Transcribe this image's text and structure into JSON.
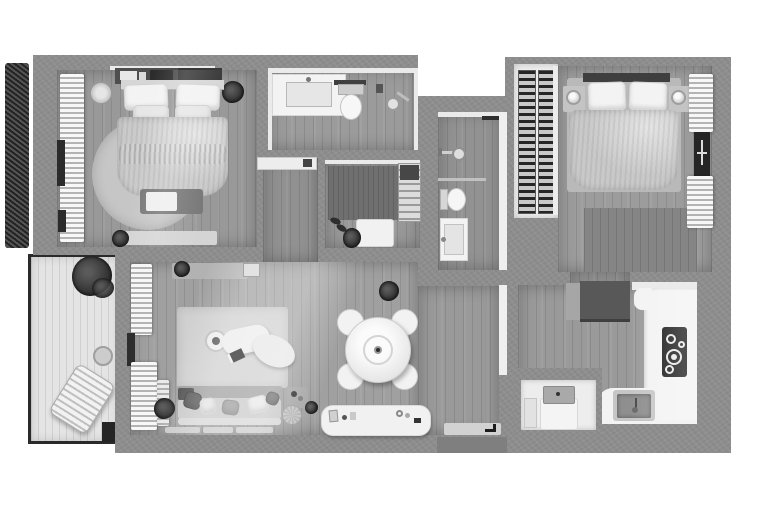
{
  "meta": {
    "type": "3d-floor-plan-render",
    "style": "grayscale top-down apartment rendering, no text labels",
    "canvas": {
      "width": 768,
      "height": 516
    }
  },
  "palette": {
    "background": "#ffffff",
    "wall_concrete": "#8d8d8d",
    "floor_wood_mid": "#9b9b9b",
    "floor_wood_dark": "#919191",
    "floor_balcony": "#e4e4e4",
    "white_fixture": "#f3f3f3",
    "textile_light": "#cbcbcb",
    "rug_light": "#d0d0d0",
    "rug_dark": "#6f6f6f",
    "appliance_dark": "#585858",
    "cooktop_black": "#161616",
    "plant_dark": "#343434",
    "window_glass": "#2b2b2b"
  },
  "rooms": [
    {
      "name": "bedroom-1",
      "furniture": [
        "double-bed",
        "headboard-console",
        "round-rug",
        "foot-bench",
        "runner-rug",
        "wardrobe-curtain-wall",
        "window",
        "basket",
        "plant",
        "plant-small"
      ]
    },
    {
      "name": "bathroom-1",
      "furniture": [
        "vanity-sink",
        "toilet",
        "shower-head",
        "wall-shelf"
      ]
    },
    {
      "name": "hallway",
      "furniture": [
        "wall-shelf-with-towel"
      ]
    },
    {
      "name": "entry-closet",
      "furniture": [
        "dark-rug",
        "shelf-unit",
        "bench",
        "shoes",
        "bag"
      ]
    },
    {
      "name": "shower-room",
      "furniture": [
        "shower-head",
        "glass-divider",
        "toilet",
        "washbasin",
        "open-door"
      ]
    },
    {
      "name": "wardrobe-niche",
      "furniture": [
        "shelf-column-left",
        "shelf-column-right"
      ]
    },
    {
      "name": "bedroom-2",
      "furniture": [
        "double-bed",
        "nightstand-left",
        "nightstand-right",
        "lamp-left",
        "lamp-right",
        "dark-rug",
        "curtains",
        "window"
      ]
    },
    {
      "name": "living-room",
      "furniture": [
        "wall-console",
        "picture-frame",
        "area-rug",
        "coffee-table",
        "curved-chaise",
        "book",
        "sofa",
        "pillows",
        "plant",
        "side-table",
        "pouf",
        "tv-sideboard",
        "floor-mats",
        "curtains",
        "window"
      ]
    },
    {
      "name": "dining-area",
      "furniture": [
        "round-table",
        "chair-1",
        "chair-2",
        "chair-3",
        "chair-4",
        "vase",
        "plant"
      ]
    },
    {
      "name": "kitchen",
      "furniture": [
        "fridge-block",
        "l-counter",
        "cooktop",
        "sink",
        "faucet"
      ]
    },
    {
      "name": "utility-closet",
      "furniture": [
        "washing-machine",
        "shelf"
      ]
    },
    {
      "name": "entry",
      "furniture": [
        "doormat",
        "arrow-mark",
        "entry-door"
      ]
    },
    {
      "name": "balcony",
      "furniture": [
        "plant",
        "side-table",
        "lounge-chair",
        "railing"
      ]
    },
    {
      "name": "garden-hedge",
      "furniture": []
    }
  ]
}
